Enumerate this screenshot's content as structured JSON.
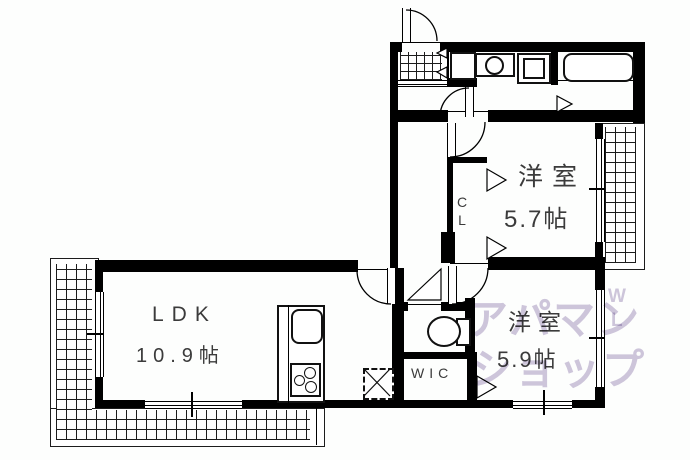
{
  "plan": {
    "rooms": {
      "ldk": {
        "name": "LDK",
        "area": "10.9帖"
      },
      "western_room_1": {
        "name": "洋室",
        "area": "5.7帖"
      },
      "western_room_2": {
        "name": "洋室",
        "area": "5.9帖"
      },
      "closet": {
        "name": "CL"
      },
      "wic": {
        "name": "WIC"
      }
    }
  },
  "watermark": {
    "line_top": "アパマン",
    "line_bottom": "ショップ",
    "mark_top": "W",
    "mark_bottom": "L",
    "color": "#cfc6dc"
  },
  "icons": {
    "entrance_door": "door-swing-icon",
    "genkan_floor": "tile-floor-icon",
    "shoe_cabinet": "shoe-cabinet-icon",
    "washbasin": "washbasin-icon",
    "washing_machine": "washing-machine-icon",
    "bathtub": "bathtub-icon",
    "toilet": "toilet-icon",
    "kitchen_sink": "kitchen-sink-icon",
    "stove": "stove-icon",
    "refrigerator_space": "refrigerator-space-icon",
    "balcony": "balcony-hatch-icon"
  },
  "colors": {
    "wall": "#000000",
    "label_text": "#3b3b3b",
    "background": "#fdfefd",
    "watermark": "#cfc6dc"
  }
}
